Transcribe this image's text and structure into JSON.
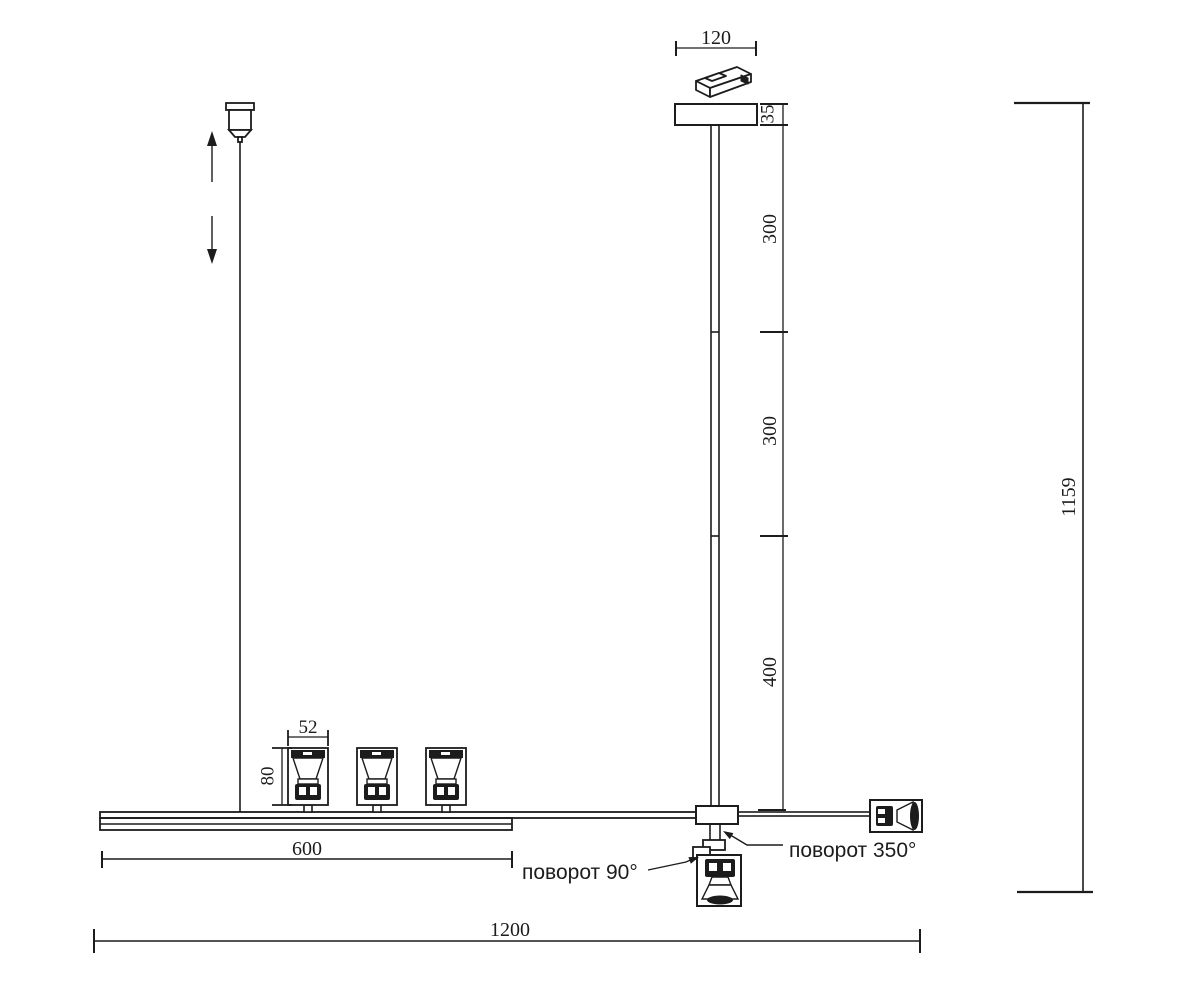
{
  "title": "Linear pendant track light — dimensional drawing",
  "units": "mm",
  "colors": {
    "line": "#1c1c1c",
    "background": "#ffffff"
  },
  "dimensions": {
    "canopy_width": "120",
    "canopy_thickness": "35",
    "rod_upper": "300",
    "rod_middle": "300",
    "rod_lower": "400",
    "overall_drop": "1159",
    "spot_head_width": "52",
    "spot_head_height": "80",
    "track_segment": "600",
    "overall_length": "1200"
  },
  "annotations": {
    "swivel_90": "поворот 90°",
    "swivel_350": "поворот 350°"
  }
}
